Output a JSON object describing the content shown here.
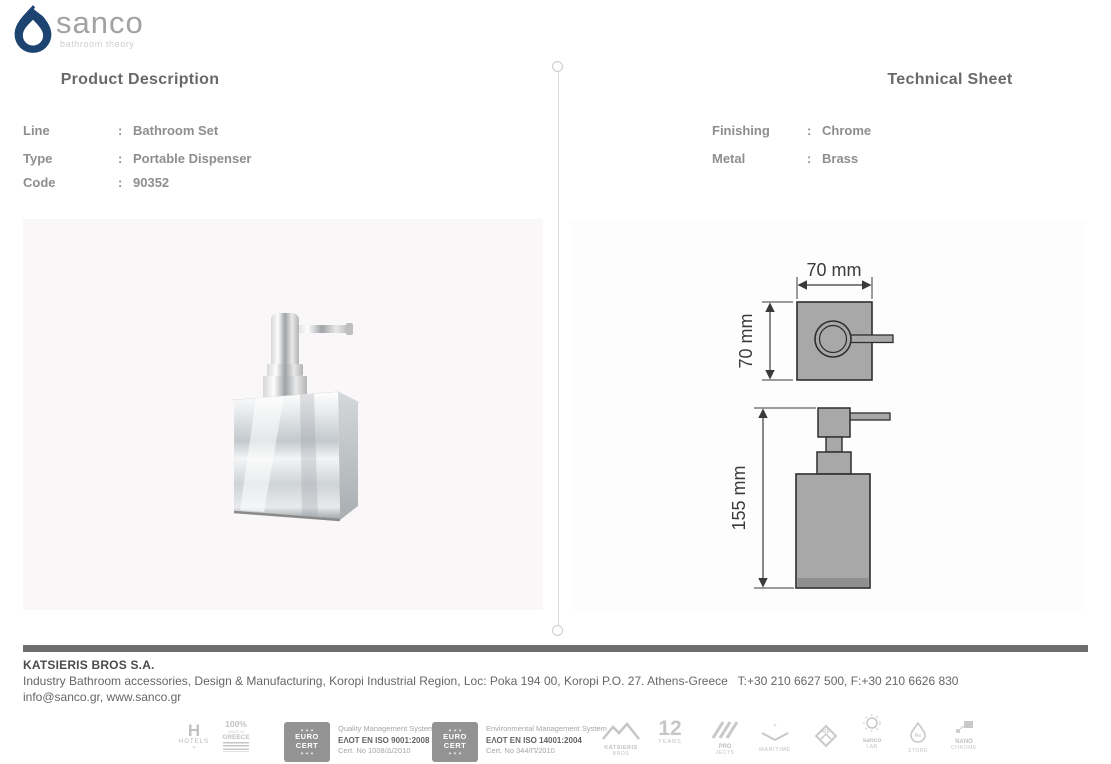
{
  "brand": {
    "name": "sanco",
    "tagline": "bathroom theory"
  },
  "product": {
    "title": "Product Description",
    "fields": [
      {
        "label": "Line",
        "colon": ":",
        "value": "Bathroom Set"
      },
      {
        "label": "Type",
        "colon": ":",
        "value": "Portable Dispenser"
      },
      {
        "label": "Code",
        "colon": ":",
        "value": "90352"
      }
    ]
  },
  "technical": {
    "title": "Technical Sheet",
    "fields": [
      {
        "label": "Finishing",
        "colon": ":",
        "value": "Chrome"
      },
      {
        "label": "Metal",
        "colon": ":",
        "value": "Brass"
      }
    ],
    "drawing": {
      "top_width": "70 mm",
      "top_depth": "70 mm",
      "height": "155 mm"
    }
  },
  "footer": {
    "company": "KATSIERIS BROS S.A.",
    "address": "Industry Bathroom accessories, Design & Manufacturing, Koropi Industrial Region, Loc: Poka 194 00, Koropi P.O. 27. Athens-Greece   T:+30 210 6627 500, F:+30 210 6626 830",
    "contact": "info@sanco.gr, www.sanco.gr"
  },
  "badges": {
    "hotels": {
      "glyph": "H",
      "label": "HOTELS",
      "star": "✶"
    },
    "greece": {
      "percent": "100%",
      "made_in": "MADE IN",
      "country": "GREECE"
    },
    "cert_quality": {
      "stars_top": "✶ ✶ ✶",
      "euro": "EURO",
      "cert": "CERT",
      "stars_bottom": "✶ ✶ ✶",
      "line1": "Quality Management System",
      "line2": "ΕΛΟΤ EN ISO 9001:2008",
      "line3": "Cert. No 1008/Δ/2010"
    },
    "cert_environment": {
      "stars_top": "✶ ✶ ✶",
      "euro": "EURO",
      "cert": "CERT",
      "stars_bottom": "✶ ✶ ✶",
      "line1": "Environmental Management System",
      "line2": "ΕΛΟΤ EN ISO 14001:2004",
      "line3": "Cert. No 344/Π/2010"
    },
    "katsieris": {
      "line1": "KATSIERIS",
      "line2": "BROS"
    },
    "years": {
      "number": "12",
      "label": "YEARS"
    },
    "projects": {
      "line1": "PRO",
      "line2": "JECTS"
    },
    "maritime": {
      "label": "MARITIME"
    },
    "home": {
      "label": "ME"
    },
    "lab": {
      "line1": "sanco",
      "line2": "LAB"
    },
    "store": {
      "line1": "Re",
      "line2": "STORE"
    },
    "nano": {
      "line1": "NANO",
      "line2": "CHROME"
    }
  }
}
